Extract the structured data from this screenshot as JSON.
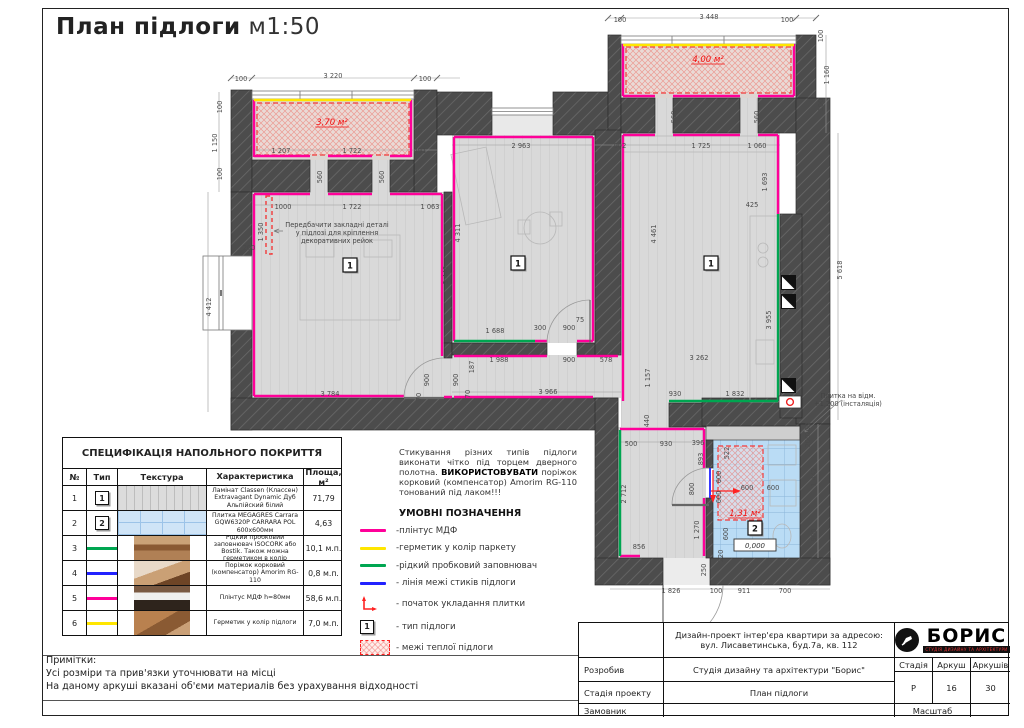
{
  "title": {
    "main": "План підлоги",
    "scale": "м1:50"
  },
  "plan": {
    "dims": [
      [
        "100",
        241,
        81,
        0
      ],
      [
        "3 220",
        333,
        78,
        0
      ],
      [
        "100",
        425,
        81,
        0
      ],
      [
        "100",
        222,
        107,
        1
      ],
      [
        "1 150",
        217,
        143,
        1
      ],
      [
        "100",
        222,
        174,
        1
      ],
      [
        "1 207",
        281,
        153,
        0
      ],
      [
        "1 722",
        352,
        153,
        0
      ],
      [
        "491",
        420,
        153,
        0
      ],
      [
        "560",
        322,
        177,
        1
      ],
      [
        "560",
        384,
        177,
        1
      ],
      [
        "1000",
        283,
        209,
        0
      ],
      [
        "1 722",
        352,
        209,
        0
      ],
      [
        "1 063",
        430,
        209,
        0
      ],
      [
        "1 350",
        263,
        232,
        1
      ],
      [
        "200",
        249,
        250,
        0
      ],
      [
        "4 412",
        211,
        307,
        1
      ],
      [
        "3 442",
        448,
        275,
        1
      ],
      [
        "3 784",
        330,
        396,
        0
      ],
      [
        "900",
        429,
        380,
        1
      ],
      [
        "70",
        421,
        397,
        1
      ],
      [
        "900",
        458,
        380,
        1
      ],
      [
        "70",
        470,
        394,
        1
      ],
      [
        "187",
        474,
        367,
        1
      ],
      [
        "2 963",
        521,
        148,
        0
      ],
      [
        "4 311",
        460,
        233,
        1
      ],
      [
        "1 688",
        495,
        333,
        0
      ],
      [
        "300",
        540,
        330,
        0
      ],
      [
        "900",
        569,
        330,
        0
      ],
      [
        "75",
        580,
        322,
        0
      ],
      [
        "1 988",
        499,
        362,
        0
      ],
      [
        "900",
        569,
        362,
        0
      ],
      [
        "578",
        606,
        362,
        0
      ],
      [
        "3 966",
        548,
        394,
        0
      ],
      [
        "902",
        620,
        148,
        0
      ],
      [
        "1 725",
        701,
        148,
        0
      ],
      [
        "1 060",
        757,
        148,
        0
      ],
      [
        "1 693",
        767,
        182,
        1
      ],
      [
        "425",
        752,
        207,
        0
      ],
      [
        "4 461",
        656,
        234,
        1
      ],
      [
        "3 955",
        771,
        320,
        1
      ],
      [
        "5 618",
        842,
        270,
        1
      ],
      [
        "3 262",
        699,
        360,
        0
      ],
      [
        "1 157",
        650,
        378,
        1
      ],
      [
        "930",
        675,
        396,
        0
      ],
      [
        "1 832",
        735,
        396,
        0
      ],
      [
        "440",
        649,
        421,
        1
      ],
      [
        "500",
        631,
        446,
        0
      ],
      [
        "930",
        666,
        446,
        0
      ],
      [
        "396",
        698,
        445,
        0
      ],
      [
        "893",
        703,
        459,
        1
      ],
      [
        "2 712",
        626,
        494,
        1
      ],
      [
        "800",
        694,
        489,
        1
      ],
      [
        "856",
        639,
        549,
        0
      ],
      [
        "1 270",
        699,
        530,
        1
      ],
      [
        "250",
        706,
        570,
        1
      ],
      [
        "1 826",
        671,
        593,
        0
      ],
      [
        "100",
        716,
        593,
        0
      ],
      [
        "911",
        744,
        593,
        0
      ],
      [
        "700",
        785,
        593,
        0
      ],
      [
        "522",
        729,
        453,
        1
      ],
      [
        "600",
        721,
        477,
        1
      ],
      [
        "600",
        721,
        497,
        1
      ],
      [
        "600",
        747,
        490,
        0
      ],
      [
        "600",
        773,
        490,
        0
      ],
      [
        "600",
        728,
        534,
        1
      ],
      [
        "220",
        723,
        556,
        1
      ],
      [
        "200",
        810,
        429,
        1
      ],
      [
        "200",
        810,
        441,
        1
      ],
      [
        "1 442",
        816,
        477,
        1
      ],
      [
        "900",
        816,
        535,
        1
      ],
      [
        "100",
        620,
        22,
        0
      ],
      [
        "3 448",
        709,
        19,
        0
      ],
      [
        "100",
        787,
        22,
        0
      ],
      [
        "100",
        823,
        36,
        1
      ],
      [
        "1 160",
        829,
        75,
        1
      ],
      [
        "100",
        823,
        105,
        1
      ],
      [
        "560",
        676,
        117,
        1
      ],
      [
        "560",
        759,
        117,
        1
      ]
    ],
    "areas": [
      {
        "t": "3,70 м²",
        "x": 332,
        "y": 125
      },
      {
        "t": "4,00 м²",
        "x": 708,
        "y": 62
      },
      {
        "t": "1,31 м²",
        "x": 745,
        "y": 516
      }
    ],
    "markers": [
      {
        "x": 343,
        "y": 258,
        "t": "1"
      },
      {
        "x": 511,
        "y": 256,
        "t": "1"
      },
      {
        "x": 704,
        "y": 256,
        "t": "1"
      },
      {
        "x": 748,
        "y": 521,
        "t": "2"
      }
    ],
    "elevation": {
      "t": "0,000",
      "x": 755,
      "y": 548
    },
    "note_rails": {
      "x": 337,
      "y": 227,
      "lines": [
        "Передбачити закладні деталі",
        "у підлозі для кріплення",
        "декоративних рейок"
      ]
    },
    "note_tile": {
      "x": 848,
      "y": 398,
      "lines": [
        "Плитка на відм.",
        "+1,200 (інсталяція)"
      ]
    }
  },
  "warning": {
    "p1": "Стикування різних типів підлоги виконати чітко під торцем дверного полотна. ",
    "bold": "ВИКОРИСТОВУВАТИ",
    "p2": " поріжок корковий (компенсатор) Amorim RG-110 тонований під лаком!!!"
  },
  "legend": {
    "title": "УМОВНІ ПОЗНАЧЕННЯ",
    "items": [
      {
        "kind": "line",
        "color": "#ff0099",
        "label": "-плінтус МДФ"
      },
      {
        "kind": "line",
        "color": "#ffe600",
        "label": "-герметик у колір паркету"
      },
      {
        "kind": "line",
        "color": "#00a651",
        "label": "-рідкий пробковий заповнювач"
      },
      {
        "kind": "line",
        "color": "#2222ff",
        "label": "- лінія межі стиків підлоги"
      },
      {
        "kind": "corner",
        "color": "#f22",
        "label": "- початок укладання плитки"
      },
      {
        "kind": "typebox",
        "symbol": "1",
        "label": "- тип підлоги"
      },
      {
        "kind": "warm",
        "label": "- межі теплої підлоги"
      }
    ]
  },
  "spec_table": {
    "title": "СПЕЦИФІКАЦІЯ НАПОЛЬНОГО ПОКРИТТЯ",
    "headers": [
      "№",
      "Тип",
      "Текстура",
      "Характеристика",
      "Площа, м²"
    ],
    "rows": [
      {
        "num": "1",
        "type_marker": "1",
        "texture": "stripes",
        "desc": "Ламінат Classen (Классен) Extravagant Dynamic Дуб Альпійский білий",
        "area": "71,79"
      },
      {
        "num": "2",
        "type_marker": "2",
        "texture": "grid",
        "desc": "Плитка MEGAGRES Carrara GQW6320P CARRARA POL 600х600мм",
        "area": "4,63"
      },
      {
        "num": "3",
        "line_color": "#00a651",
        "texture": "ph1",
        "desc": "Рідкий пробковий заповнювач ISOCORK або Bostik. Також можна герметиком в колір",
        "area": "10,1 м.п."
      },
      {
        "num": "4",
        "line_color": "#2222ff",
        "texture": "ph2",
        "desc": "Поріжок корковий (компенсатор) Amorim RG-110",
        "area": "0,8 м.п."
      },
      {
        "num": "5",
        "line_color": "#ff0099",
        "texture": "ph3",
        "desc": "Плінтус МДФ h=80мм",
        "area": "58,6 м.п."
      },
      {
        "num": "6",
        "line_color": "#ffe600",
        "texture": "ph4",
        "desc": "Герметик у колір підлоги",
        "area": "7,0 м.п."
      }
    ]
  },
  "notes": {
    "title": "Примітки:",
    "lines": [
      "Усі розміри та прив'язки уточнювати на місці",
      "На даному аркуші вказані об'єми материалів без урахування відходності"
    ]
  },
  "titleblock": {
    "address_line1": "Дизайн-проект інтер'єра квартири за адресою:",
    "address_line2": "вул. Лисаветинська, буд.7а, кв. 112",
    "rows": [
      {
        "label": "Розробив",
        "value": "Студія дизайну та архітектури \"Борис\""
      },
      {
        "label": "Стадія проекту",
        "value": "План підлоги"
      },
      {
        "label": "Замовник",
        "value": ""
      }
    ],
    "stage_label": "Стадія",
    "sheet_label": "Аркуш",
    "sheets_label": "Аркушів",
    "stage_value": "Р",
    "sheet_value": "16",
    "sheets_value": "30",
    "scale_label": "Масштаб",
    "logo": {
      "name": "БОРИС",
      "sub": "СТУДІЯ ДИЗАЙНУ ТА АРХІТЕКТУРИ"
    }
  },
  "colors": {
    "plinth": "#ff0099",
    "sealant": "#ffe600",
    "cork": "#00a651",
    "joint": "#2222ff",
    "warm": "#f22222",
    "wall": "#4c4c4c",
    "laminate": "#d9d9d9",
    "tile": "#badcf5"
  }
}
